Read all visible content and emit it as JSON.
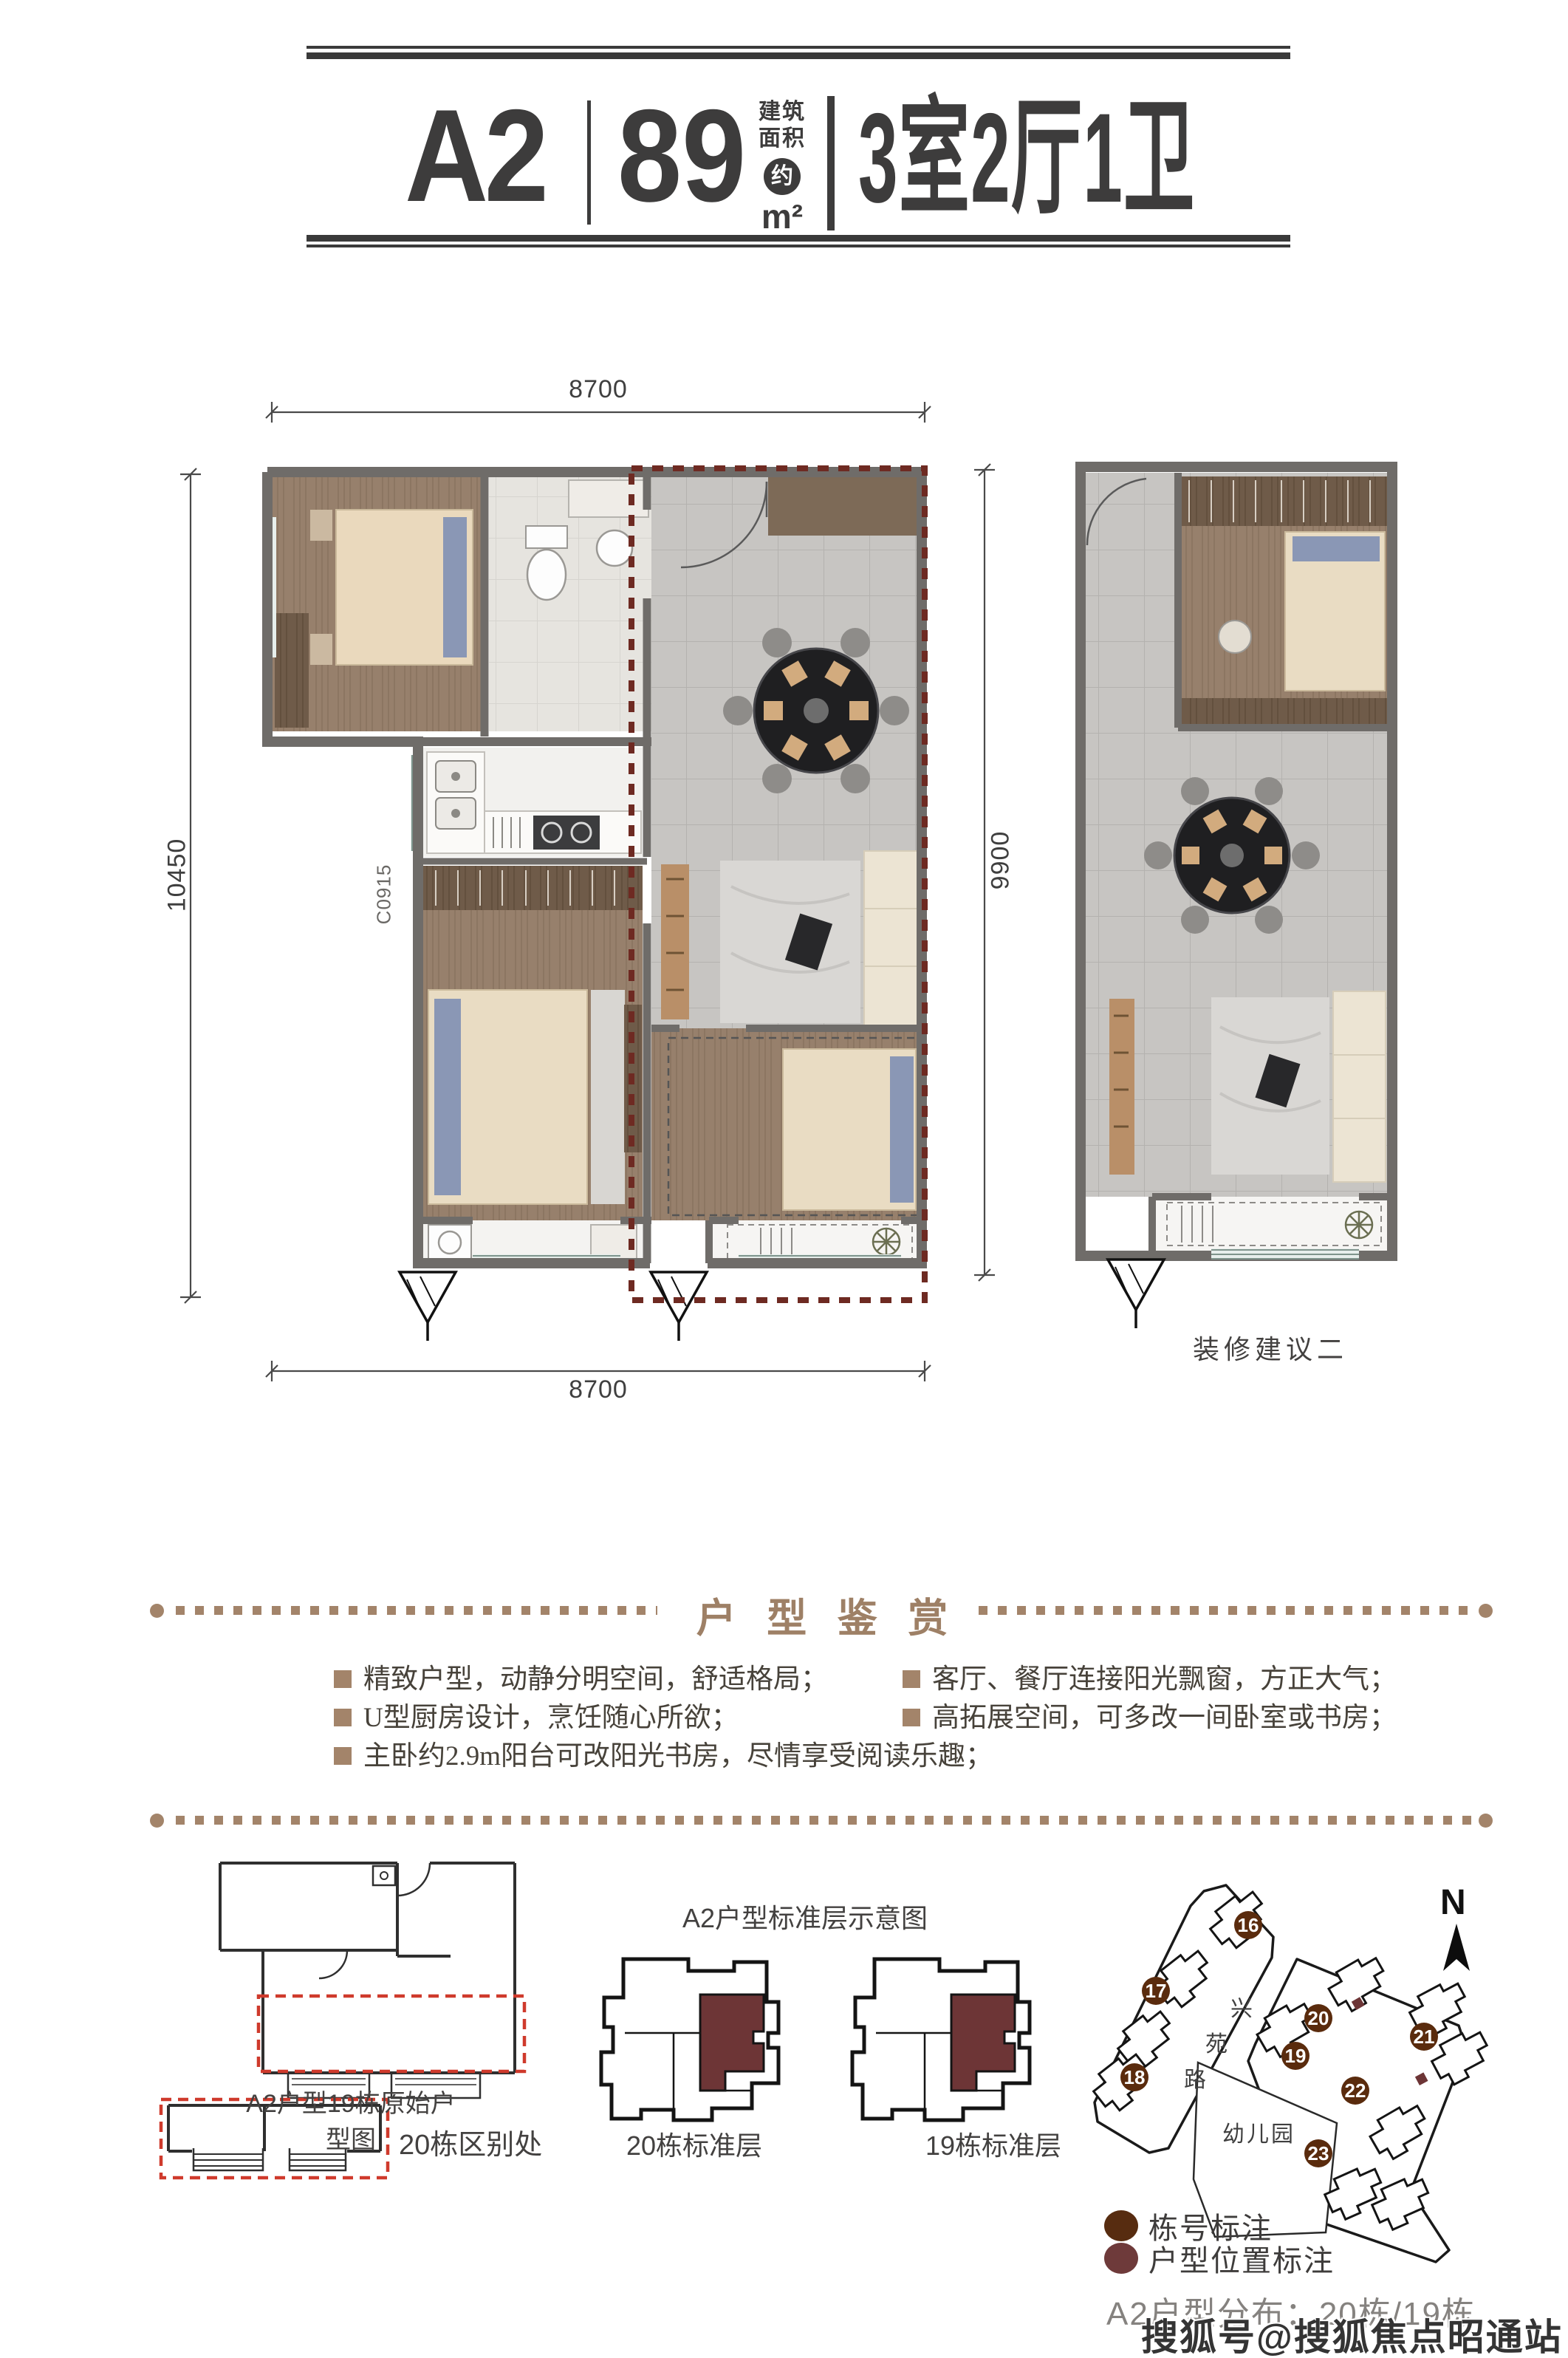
{
  "header": {
    "unit_code": "A2",
    "area_value": "89",
    "area_approx": "约",
    "area_unit": "m²",
    "area_label_line1": "建筑",
    "area_label_line2": "面积",
    "layout_text": "3室2厅1卫"
  },
  "floorplan": {
    "dim_top": "8700",
    "dim_bottom": "8700",
    "dim_left": "10450",
    "dim_right": "9900",
    "window_code": "C0915",
    "variant_label": "装修建议二"
  },
  "appreciation": {
    "title": "户 型 鉴 赏",
    "bullets_left": [
      "精致户型，动静分明空间，舒适格局；",
      "U型厨房设计，烹饪随心所欲；",
      "主卧约2.9m阳台可改阳光书房，尽情享受阅读乐趣；"
    ],
    "bullets_right": [
      "客厅、餐厅连接阳光飘窗，方正大气；",
      "高拓展空间，可多改一间卧室或书房；"
    ]
  },
  "bottom": {
    "original_plan_caption": "A2户型19栋原始户型图",
    "difference_caption": "20栋区别处",
    "standard_floor_title": "A2户型标准层示意图",
    "building20_caption": "20栋标准层",
    "building19_caption": "19栋标准层"
  },
  "sitemap": {
    "north_label": "N",
    "road_chars": [
      "兴",
      "苑",
      "路"
    ],
    "kindergarten_label": "幼儿园",
    "buildings": [
      "16",
      "17",
      "18",
      "19",
      "20",
      "21",
      "22",
      "23"
    ],
    "legend_building": "栋号标注",
    "legend_unit": "户型位置标注",
    "distribution_text": "A2户型分布：20栋/19栋"
  },
  "watermark": "搜狐号@搜狐焦点昭通站",
  "colors": {
    "accent_tan": "#a3846a",
    "unit_maroon": "#6d3536",
    "legend_brown": "#5a2b0d",
    "legend_maroon": "#6e3a3a",
    "highlight_red": "#cf3a2c",
    "plan_dash_maroon": "#6e2a22"
  }
}
